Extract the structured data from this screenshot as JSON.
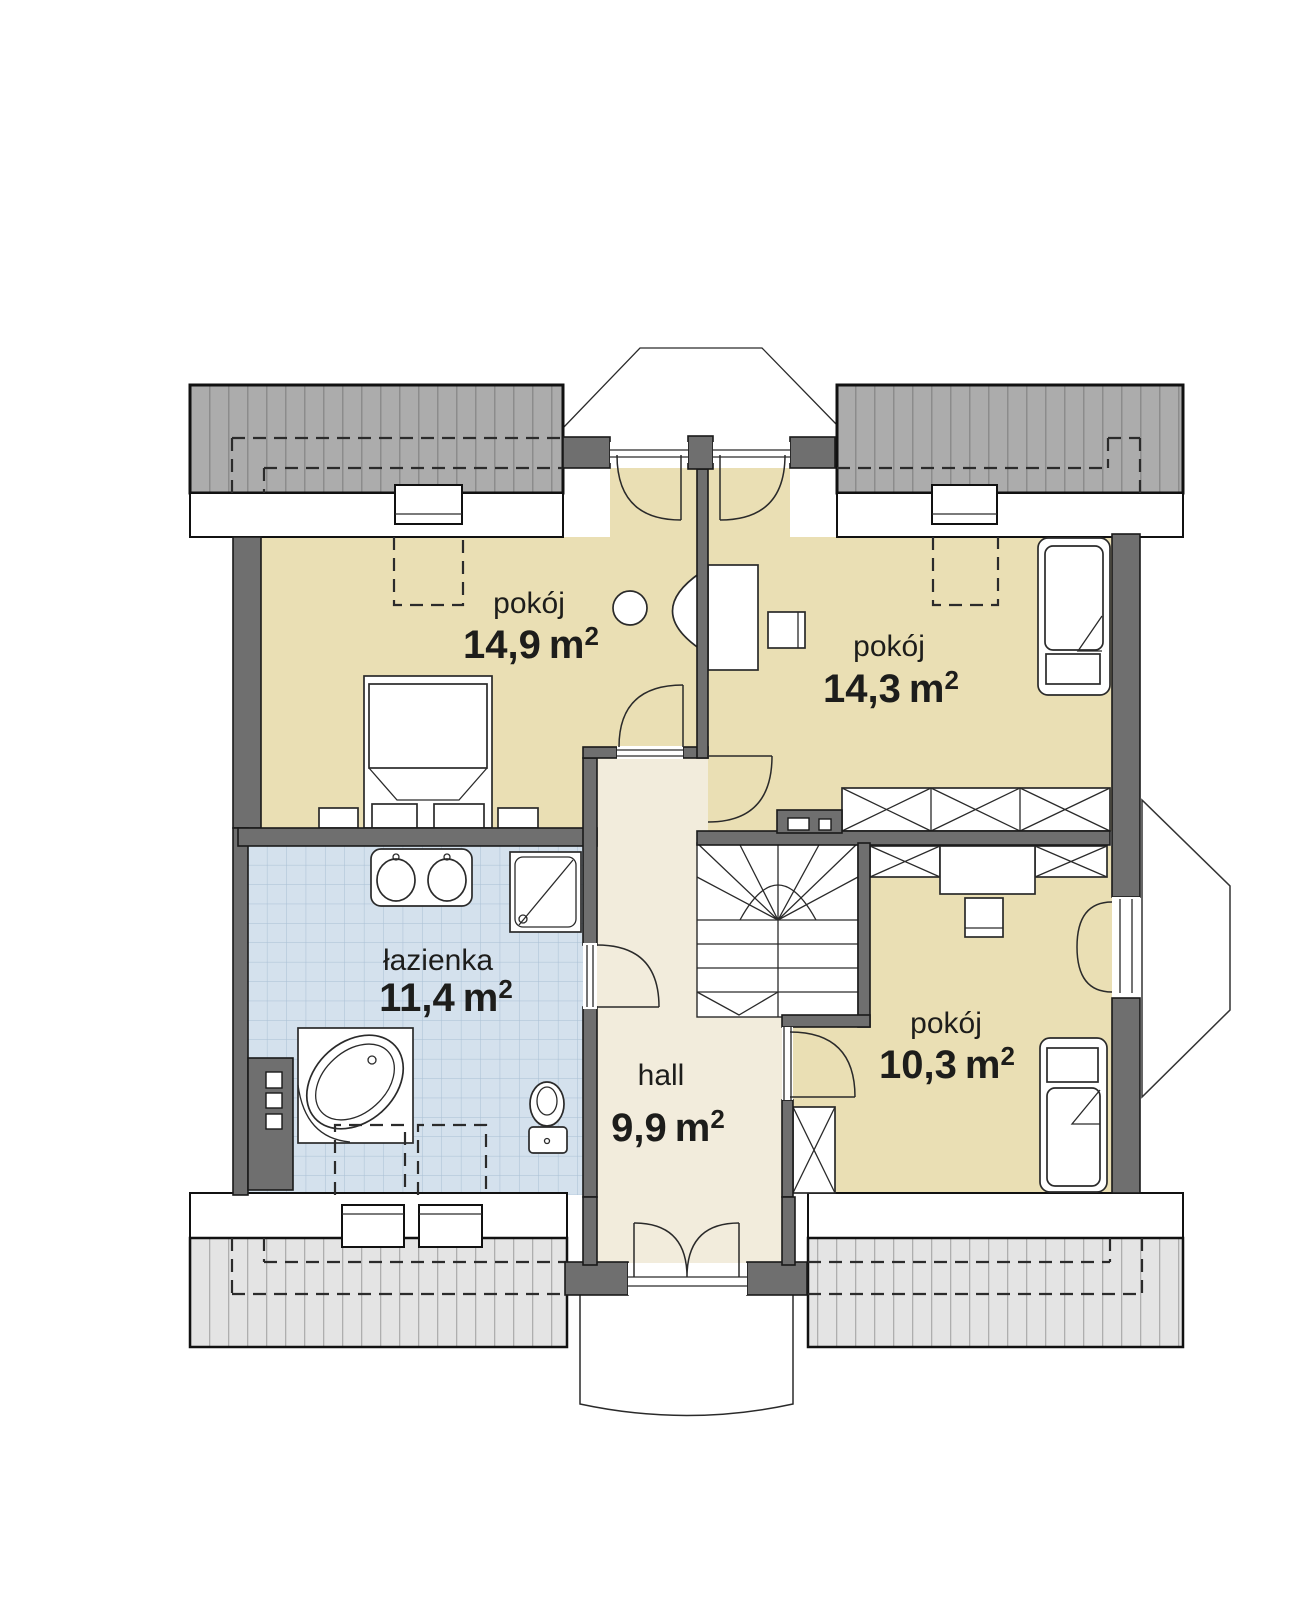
{
  "plan_type": "floor-plan",
  "rooms": [
    {
      "id": "room-top-left",
      "name": "pokój",
      "area_value": "14,9",
      "area_unit": "m",
      "area_sup": "2"
    },
    {
      "id": "room-top-right",
      "name": "pokój",
      "area_value": "14,3",
      "area_unit": "m",
      "area_sup": "2"
    },
    {
      "id": "bathroom",
      "name": "łazienka",
      "area_value": "11,4",
      "area_unit": "m",
      "area_sup": "2"
    },
    {
      "id": "hall",
      "name": "hall",
      "area_value": "9,9",
      "area_unit": "m",
      "area_sup": "2"
    },
    {
      "id": "room-bottom-right",
      "name": "pokój",
      "area_value": "10,3",
      "area_unit": "m",
      "area_sup": "2"
    }
  ],
  "colors": {
    "room_floor": "#eadfb4",
    "hall_floor": "#f2ecdc",
    "bath_floor": "#d4e1ed",
    "bath_grid": "#a9bfd4",
    "wall": "#6f6f6f",
    "roof_dark": "#acacac",
    "roof_dark_stripe": "#8c8c8c",
    "roof_light": "#e4e4e4",
    "roof_light_stripe": "#aeaeae",
    "outline": "#1a1a1a",
    "text": "#1d1d1b"
  }
}
